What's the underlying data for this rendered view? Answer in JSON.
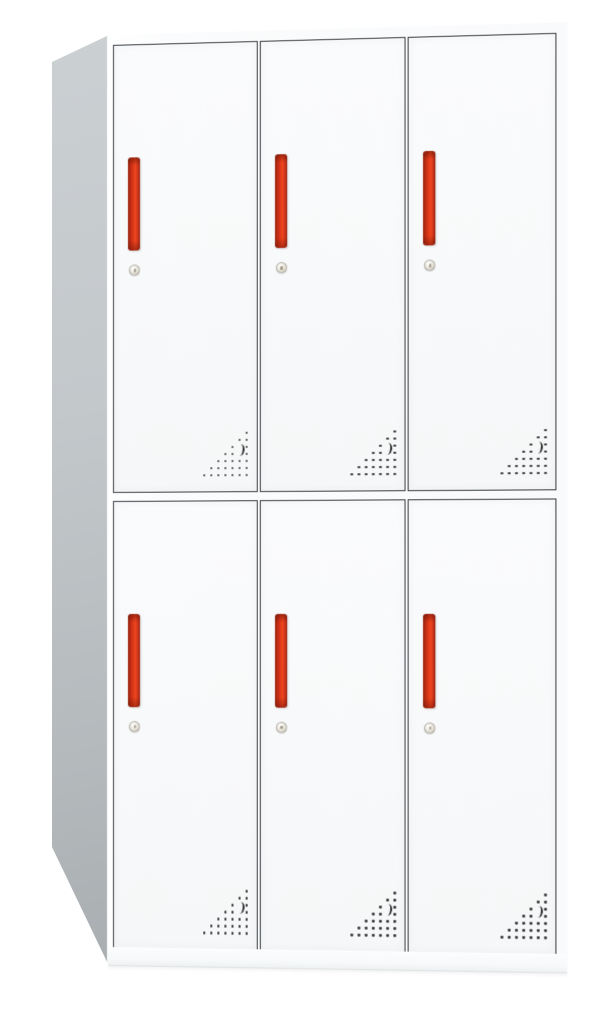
{
  "scene": {
    "description": "Product photo of a six-door steel locker cabinet on a plain white background, viewed from the front-left with the gray left side panel visible in perspective",
    "object": "locker-cabinet",
    "door_rows": 2,
    "door_columns": 3,
    "door_count": 6,
    "door_features": [
      "vertical red handle",
      "round silver cam lock",
      "triangular perforated vent pattern at bottom-right"
    ]
  },
  "doors": [
    {
      "id": "door-1",
      "row": 1,
      "column": 1
    },
    {
      "id": "door-2",
      "row": 1,
      "column": 2
    },
    {
      "id": "door-3",
      "row": 1,
      "column": 3
    },
    {
      "id": "door-4",
      "row": 2,
      "column": 1
    },
    {
      "id": "door-5",
      "row": 2,
      "column": 2
    },
    {
      "id": "door-6",
      "row": 2,
      "column": 3
    }
  ],
  "vent_pattern": {
    "columns": 7,
    "rows_dot_counts": [
      1,
      2,
      3,
      4,
      5,
      6,
      7
    ],
    "skip_cells": [
      [
        2,
        5
      ],
      [
        3,
        5
      ]
    ],
    "crescent_cell": [
      2,
      5
    ],
    "cell_size_px": 7
  },
  "colors": {
    "background": "#ffffff",
    "face_white": "#fbfcfd",
    "door_white": "#f8f9fa",
    "outline_dark": "#3c4043",
    "side_light": "#cbd0d3",
    "side_dark": "#a9aeb1",
    "handle_red": "#d53318",
    "handle_bright": "#ee461f",
    "handle_dark_red": "#97230f",
    "lock_silver": "#e6e2d8",
    "vent_dot": "#3a3a3a",
    "base_edge": "#dfe2e4"
  }
}
